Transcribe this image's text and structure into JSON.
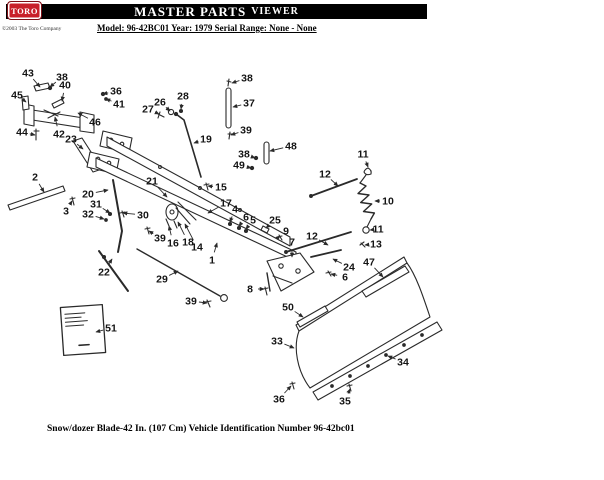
{
  "header": {
    "logo_text": "TORO",
    "title_main": "MASTER PARTS",
    "title_sub": "VIEWER",
    "copyright": "©2003 The Toro Company",
    "model_line": "Model: 96-42BC01  Year: 1979  Serial Range: None - None"
  },
  "caption": "Snow/dozer Blade-42 In. (107 Cm) Vehicle Identification Number 96-42bc01",
  "colors": {
    "accent_red": "#c8202a",
    "bar_black": "#000000",
    "ink": "#2a2a2a"
  },
  "diagram": {
    "description": "Exploded parts diagram of snow/dozer blade with numbered callouts",
    "callouts": [
      {
        "n": "43",
        "lx": 28,
        "ly": 73,
        "tx": 40,
        "ty": 87
      },
      {
        "n": "38",
        "lx": 62,
        "ly": 77,
        "tx": 50,
        "ty": 87
      },
      {
        "n": "40",
        "lx": 65,
        "ly": 85,
        "tx": 62,
        "ty": 101
      },
      {
        "n": "45",
        "lx": 17,
        "ly": 95,
        "tx": 26,
        "ty": 102
      },
      {
        "n": "36",
        "lx": 116,
        "ly": 91,
        "tx": 103,
        "ty": 94
      },
      {
        "n": "41",
        "lx": 119,
        "ly": 104,
        "tx": 106,
        "ty": 99
      },
      {
        "n": "46",
        "lx": 95,
        "ly": 122,
        "tx": 78,
        "ty": 113
      },
      {
        "n": "44",
        "lx": 22,
        "ly": 132,
        "tx": 35,
        "ty": 135
      },
      {
        "n": "42",
        "lx": 59,
        "ly": 134,
        "tx": 55,
        "ty": 117
      },
      {
        "n": "23",
        "lx": 71,
        "ly": 139,
        "tx": 83,
        "ty": 149
      },
      {
        "n": "2",
        "lx": 35,
        "ly": 177,
        "tx": 44,
        "ty": 192
      },
      {
        "n": "3",
        "lx": 66,
        "ly": 211,
        "tx": 72,
        "ty": 201
      },
      {
        "n": "20",
        "lx": 88,
        "ly": 194,
        "tx": 108,
        "ty": 190
      },
      {
        "n": "31",
        "lx": 96,
        "ly": 204,
        "tx": 110,
        "ty": 213
      },
      {
        "n": "32",
        "lx": 88,
        "ly": 214,
        "tx": 104,
        "ty": 219
      },
      {
        "n": "30",
        "lx": 143,
        "ly": 215,
        "tx": 123,
        "ty": 213
      },
      {
        "n": "22",
        "lx": 104,
        "ly": 272,
        "tx": 112,
        "ty": 259
      },
      {
        "n": "29",
        "lx": 162,
        "ly": 279,
        "tx": 178,
        "ty": 271
      },
      {
        "n": "39",
        "lx": 191,
        "ly": 301,
        "tx": 207,
        "ty": 303
      },
      {
        "n": "51",
        "lx": 111,
        "ly": 328,
        "tx": 96,
        "ty": 332
      },
      {
        "n": "27",
        "lx": 148,
        "ly": 109,
        "tx": 159,
        "ty": 114
      },
      {
        "n": "26",
        "lx": 160,
        "ly": 102,
        "tx": 170,
        "ty": 111
      },
      {
        "n": "28",
        "lx": 183,
        "ly": 96,
        "tx": 181,
        "ty": 109
      },
      {
        "n": "19",
        "lx": 206,
        "ly": 139,
        "tx": 194,
        "ty": 143
      },
      {
        "n": "15",
        "lx": 221,
        "ly": 187,
        "tx": 208,
        "ty": 186
      },
      {
        "n": "21",
        "lx": 152,
        "ly": 181,
        "tx": 167,
        "ty": 197
      },
      {
        "n": "17",
        "lx": 226,
        "ly": 203,
        "tx": 208,
        "ty": 213
      },
      {
        "n": "16",
        "lx": 173,
        "ly": 243,
        "tx": 169,
        "ty": 226
      },
      {
        "n": "18",
        "lx": 188,
        "ly": 242,
        "tx": 178,
        "ty": 222
      },
      {
        "n": "14",
        "lx": 197,
        "ly": 247,
        "tx": 185,
        "ty": 224
      },
      {
        "n": "39",
        "lx": 160,
        "ly": 238,
        "tx": 149,
        "ty": 231
      },
      {
        "n": "1",
        "lx": 212,
        "ly": 260,
        "tx": 217,
        "ty": 243
      },
      {
        "n": "4",
        "lx": 235,
        "ly": 209,
        "tx": 230,
        "ty": 222
      },
      {
        "n": "6",
        "lx": 246,
        "ly": 217,
        "tx": 239,
        "ty": 226
      },
      {
        "n": "5",
        "lx": 253,
        "ly": 220,
        "tx": 246,
        "ty": 229
      },
      {
        "n": "25",
        "lx": 275,
        "ly": 220,
        "tx": 266,
        "ty": 228
      },
      {
        "n": "9",
        "lx": 286,
        "ly": 231,
        "tx": 280,
        "ty": 236
      },
      {
        "n": "7",
        "lx": 292,
        "ly": 242,
        "tx": 292,
        "ty": 257
      },
      {
        "n": "8",
        "lx": 250,
        "ly": 289,
        "tx": 264,
        "ty": 289
      },
      {
        "n": "38",
        "lx": 247,
        "ly": 78,
        "tx": 232,
        "ty": 83
      },
      {
        "n": "37",
        "lx": 249,
        "ly": 103,
        "tx": 233,
        "ty": 107
      },
      {
        "n": "39",
        "lx": 246,
        "ly": 130,
        "tx": 231,
        "ty": 135
      },
      {
        "n": "48",
        "lx": 291,
        "ly": 146,
        "tx": 270,
        "ty": 151
      },
      {
        "n": "38",
        "lx": 244,
        "ly": 154,
        "tx": 255,
        "ty": 158
      },
      {
        "n": "49",
        "lx": 239,
        "ly": 165,
        "tx": 251,
        "ty": 168
      },
      {
        "n": "11",
        "lx": 363,
        "ly": 154,
        "tx": 368,
        "ty": 167
      },
      {
        "n": "12",
        "lx": 325,
        "ly": 174,
        "tx": 338,
        "ty": 186
      },
      {
        "n": "10",
        "lx": 388,
        "ly": 201,
        "tx": 375,
        "ty": 201
      },
      {
        "n": "11",
        "lx": 378,
        "ly": 229,
        "tx": 370,
        "ty": 230
      },
      {
        "n": "12",
        "lx": 312,
        "ly": 236,
        "tx": 328,
        "ty": 245
      },
      {
        "n": "13",
        "lx": 376,
        "ly": 244,
        "tx": 365,
        "ty": 245
      },
      {
        "n": "24",
        "lx": 349,
        "ly": 267,
        "tx": 333,
        "ty": 259
      },
      {
        "n": "6",
        "lx": 345,
        "ly": 277,
        "tx": 331,
        "ty": 274
      },
      {
        "n": "47",
        "lx": 369,
        "ly": 262,
        "tx": 383,
        "ty": 277
      },
      {
        "n": "50",
        "lx": 288,
        "ly": 307,
        "tx": 303,
        "ty": 317
      },
      {
        "n": "33",
        "lx": 277,
        "ly": 341,
        "tx": 294,
        "ty": 348
      },
      {
        "n": "34",
        "lx": 403,
        "ly": 362,
        "tx": 388,
        "ty": 356
      },
      {
        "n": "35",
        "lx": 345,
        "ly": 401,
        "tx": 350,
        "ty": 389
      },
      {
        "n": "36",
        "lx": 279,
        "ly": 399,
        "tx": 291,
        "ty": 386
      }
    ]
  }
}
